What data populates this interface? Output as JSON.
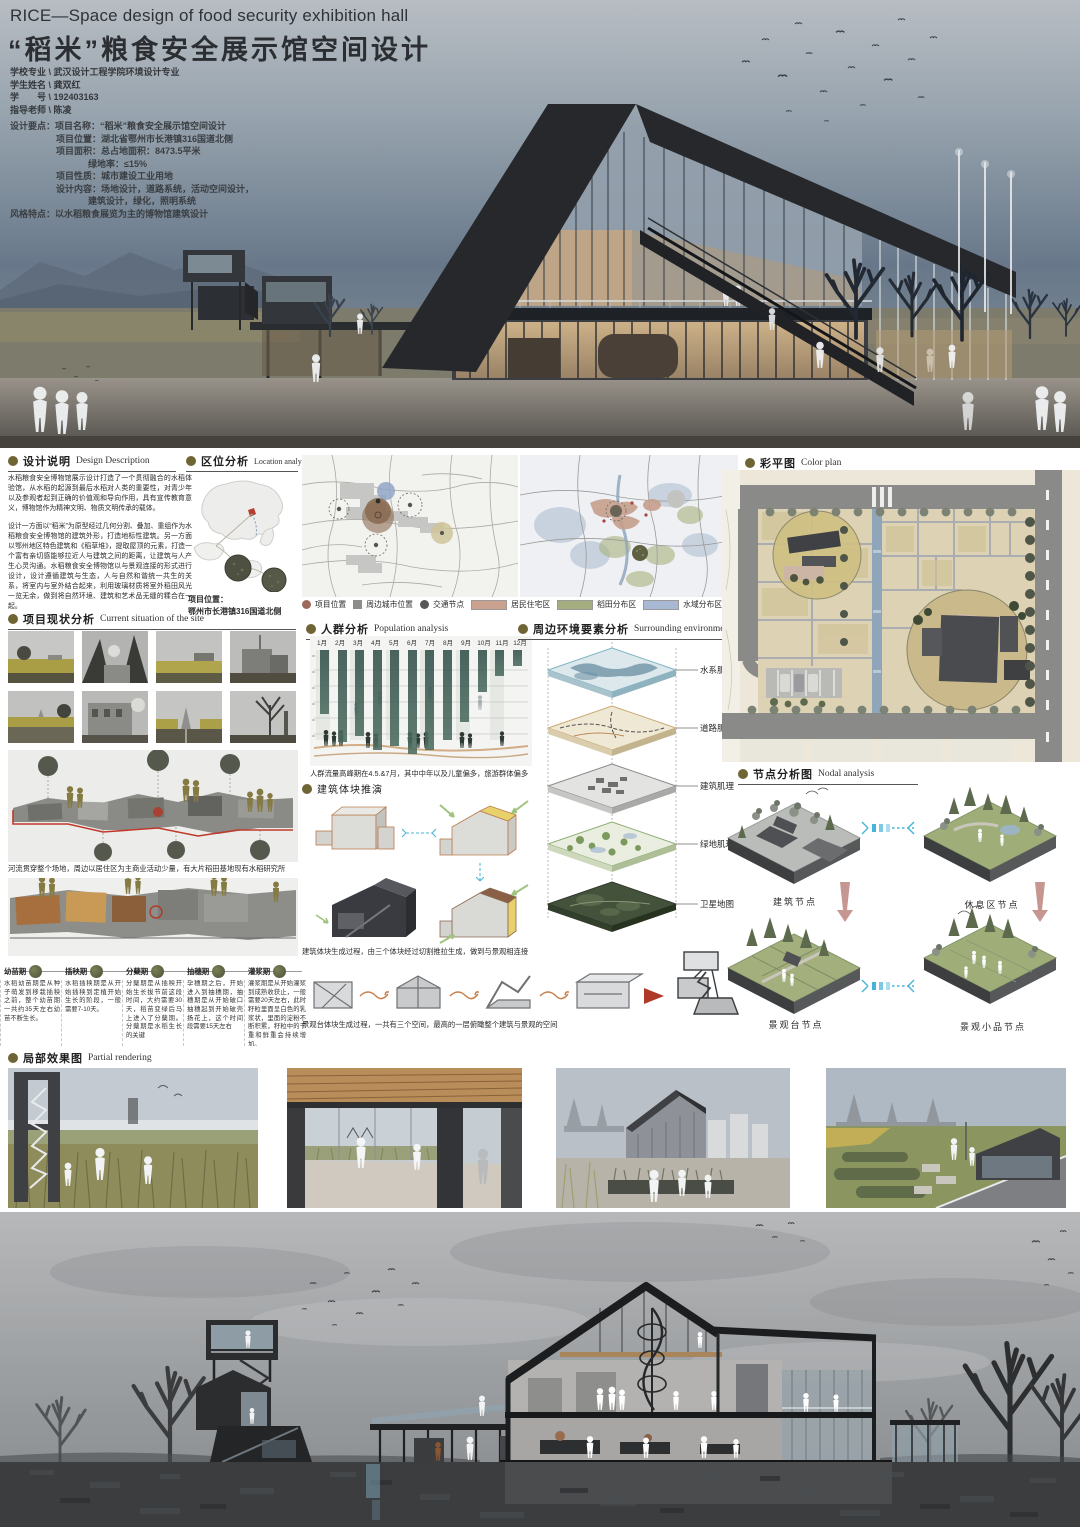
{
  "header": {
    "title_en": "RICE—Space design of food security exhibition hall",
    "title_zh": "“稻米”粮食安全展示馆空间设计",
    "info": [
      "学校专业 \\ 武汉设计工程学院环境设计专业",
      "学生姓名 \\ 龚双红",
      "学　　号 \\ 192403163",
      "指导老师 \\ 陈凌"
    ],
    "brief": [
      {
        "t": "设计要点：项目名称：“稻米”粮食安全展示馆空间设计"
      },
      {
        "t": "项目位置：湖北省鄂州市长港镇316国道北侧"
      },
      {
        "t": "项目面积：总占地面积：8473.5平米"
      },
      {
        "t": "绿地率：≤15%"
      },
      {
        "t": "项目性质：城市建设工业用地"
      },
      {
        "t": "设计内容：场地设计，道路系统，活动空间设计，"
      },
      {
        "t": "建筑设计，绿化，照明系统"
      },
      {
        "t": "风格特点：以水稻粮食展览为主的博物馆建筑设计"
      }
    ]
  },
  "design_description": {
    "title_zh": "设计说明",
    "title_en": "Design Description",
    "p1": "水稻粮食安全博物馆展示设计打造了一个贯彻融合的水稻体验馆，从水稻的起源到最后水稻对人类的重要性，对青少年以及参观者起到正确的价值观和导向作用，具有宣传教育意义，博物馆作为精神文明、物质文明传承的载体。",
    "p2": "设计一方面以“稻米”为原型经过几何分割、叠加、重组作为水稻粮食安全博物馆的建筑外形，打造地标性建筑。另一方面以鄂州地区特色建筑和《稻草堆》，提取屋顶的元素，打造一个富有亲切感能够拉近人与建筑之间的距离，让建筑与人产生心灵沟通。水稻粮食安全博物馆以与景观连接的形式进行设计，设计遵循建筑与生态，人与自然和谐统一共生的关系，将室内与室外结合起来，利用玻璃材质将室外稻田风光一览无余，做到将自然环境、建筑和艺术品无缝的糅合在一起。"
  },
  "location": {
    "title_zh": "区位分析",
    "title_en": "Location analysis",
    "note_label": "项目位置：",
    "note_value": "鄂州市长港镇316国道北侧",
    "legend": [
      {
        "label": "项目位置",
        "color": "#9b6a5c",
        "shape": "circle"
      },
      {
        "label": "周边城市位置",
        "color": "#8d8d8b",
        "shape": "square"
      },
      {
        "label": "交通节点",
        "color": "#57575a",
        "shape": "circle"
      },
      {
        "label": "居民住宅区",
        "color": "#c9a18e",
        "shape": "rect"
      },
      {
        "label": "稻田分布区",
        "color": "#a3ad7e",
        "shape": "rect"
      },
      {
        "label": "水域分布区",
        "color": "#a9b9d3",
        "shape": "rect"
      }
    ]
  },
  "site": {
    "title_zh": "项目现状分析",
    "title_en": "Current situation of the site",
    "caption": "河流贯穿整个场地，周边以居住区为主商业活动少量，有大片稻田基地现有水稻研究所"
  },
  "population": {
    "title_zh": "人群分析",
    "title_en": "Population analysis",
    "months": [
      "1月",
      "2月",
      "3月",
      "4月",
      "5月",
      "6月",
      "7月",
      "8月",
      "9月",
      "10月",
      "11月",
      "12月"
    ],
    "bars": [
      "64px",
      "92px",
      "86px",
      "100px",
      "96px",
      "104px",
      "100px",
      "90px",
      "72px",
      "42px",
      "26px",
      "16px"
    ],
    "caption": "人群流量高峰期在4.5.&7月，其中中年以及儿童偏多，旅游群体偏多"
  },
  "surrounding": {
    "title_zh": "周边环境要素分析",
    "title_en": "Surrounding environment",
    "layers": [
      "水系肌理",
      "道路肌理",
      "建筑肌理",
      "绿地肌理",
      "卫星地图"
    ]
  },
  "massing": {
    "title_zh": "建筑体块推演",
    "caption1": "建筑体块生成过程，由三个体块经过切割推拉生成，做到与景观相连接",
    "caption2": "景观台体块生成过程，一共有三个空间，最高的一层俯瞰整个建筑与景观的空间"
  },
  "colorplan": {
    "title_zh": "彩平图",
    "title_en": "Color plan"
  },
  "nodal": {
    "title_zh": "节点分析图",
    "title_en": "Nodal analysis",
    "nodes": [
      "建筑节点",
      "休息区节点",
      "景观台节点",
      "景观小品节点"
    ]
  },
  "growth": {
    "stages": [
      {
        "title": "幼苗期",
        "text": "水稻幼苗期是从种子萌发到移栽插秧之前，整个幼苗期一共约35天左右幼苗不断生长。"
      },
      {
        "title": "插秧期",
        "text": "水稻插秧期是从开始插秧到定植开始生长的阶段，一般需要7-10天。"
      },
      {
        "title": "分蘖期",
        "text": "分蘖期是从插秧开始生长拔节前这段时间，大约需要30天，稻苗变绿后马上进入了分蘖期。分蘖期是水稻生长的关键"
      },
      {
        "title": "抽穗期",
        "text": "孕穗期之后，开始进入到抽穗期，抽穗期是从开始破口抽穗起到开始破壳扬花上，这个时间段需要15天左右"
      },
      {
        "title": "灌浆期",
        "text": "灌浆期是从开始灌浆到成熟收获止，一般需要20天左右，此时籽粒里面呈白色的乳浆状，里面的淀粉不断积累，籽粒中的干重和鲜重会持续增加。"
      }
    ]
  },
  "partial": {
    "title_zh": "局部效果图",
    "title_en": "Partial rendering"
  },
  "colors": {
    "accent_olive": "#6e6434",
    "hero_sky": "#6e7d8d",
    "building_dark": "#26282c",
    "warm_light": "#caa87e",
    "bottom_sky": "#b0b1b3",
    "ground_dark": "#3b3d3f"
  }
}
